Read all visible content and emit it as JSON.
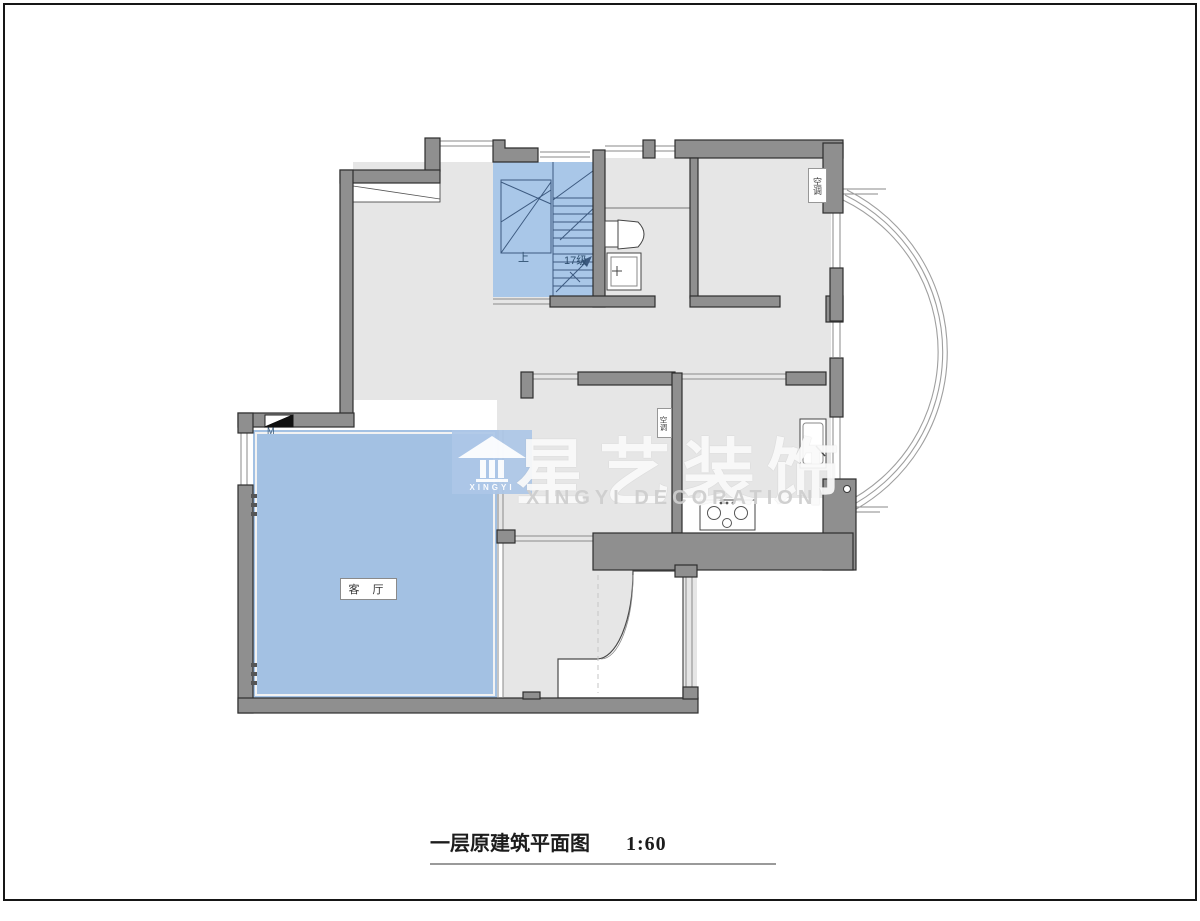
{
  "page": {
    "frame_color": "#161616",
    "background": "#ffffff"
  },
  "caption": {
    "title": "一层原建筑平面图",
    "scale": "1:60"
  },
  "watermark": {
    "logo_text": "XINGYI",
    "brand": "星艺装饰",
    "brand_sub": "XINGYI DECORATION"
  },
  "plan": {
    "labels": {
      "living_room": "客 厅",
      "stairs_up": "上",
      "stairs_count": "17级",
      "ac_top_room": "空调",
      "ac_middle_room": "空调",
      "door_marker": "M"
    },
    "colors": {
      "wall": "#8f8f8f",
      "wall_outline": "#2e2e2e",
      "floor": "#e6e6e6",
      "stairs_fill": "#a9c7e8",
      "living_fill": "#a3c1e3",
      "stair_line": "#3d5a80",
      "window_line": "#8a8a8a"
    }
  }
}
